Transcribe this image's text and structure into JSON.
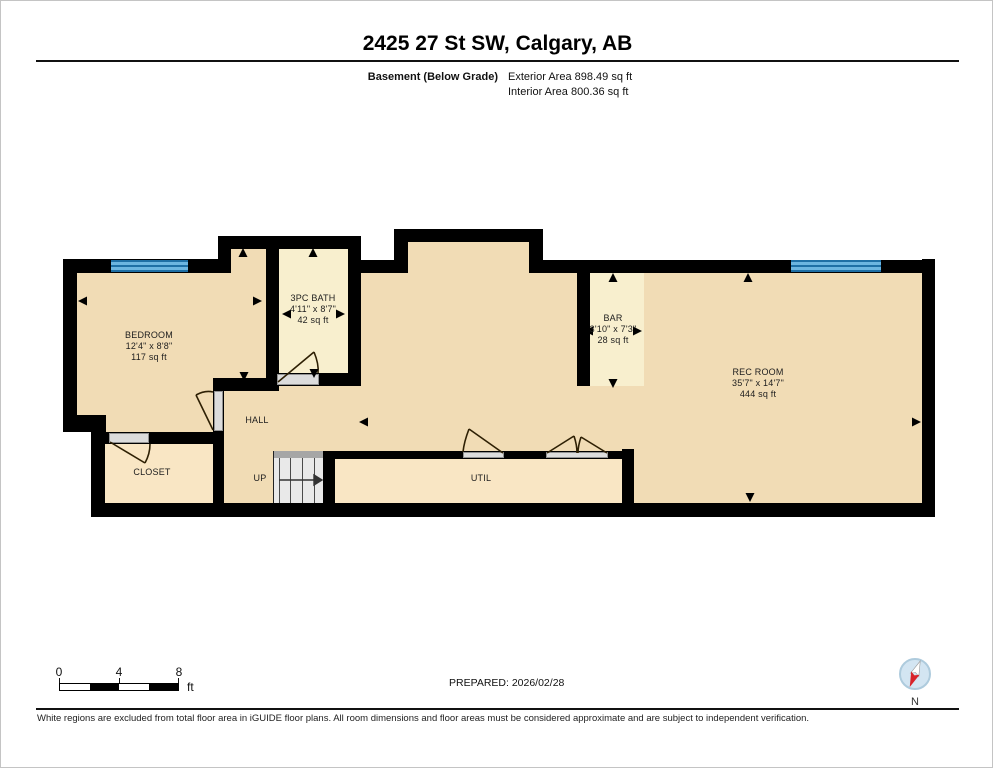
{
  "header": {
    "title": "2425 27 St SW, Calgary, AB",
    "floor_label": "Basement (Below Grade)",
    "exterior_area": "Exterior Area 898.49 sq ft",
    "interior_area": "Interior Area 800.36 sq ft"
  },
  "rooms": [
    {
      "name": "BEDROOM",
      "dims": "12'4\" x 8'8\"",
      "area": "117 sq ft"
    },
    {
      "name": "3PC BATH",
      "dims": "4'11\" x 8'7\"",
      "area": "42 sq ft"
    },
    {
      "name": "BAR",
      "dims": "3'10\" x 7'3\"",
      "area": "28 sq ft"
    },
    {
      "name": "REC ROOM",
      "dims": "35'7\" x 14'7\"",
      "area": "444 sq ft"
    }
  ],
  "labels": {
    "hall": "HALL",
    "closet": "CLOSET",
    "util": "UTIL",
    "up": "UP"
  },
  "scale": {
    "t0": "0",
    "t4": "4",
    "t8": "8",
    "unit": "ft"
  },
  "footer": {
    "prepared": "PREPARED: 2026/02/28",
    "disclaimer": "White regions are excluded from total floor area in iGUIDE floor plans. All room dimensions and floor areas must be considered approximate and are subject to independent verification.",
    "compass_label": "N"
  },
  "colors": {
    "floor_main": "#f1dcb5",
    "floor_bath_bar": "#f8efce",
    "floor_util_closet": "#f9e6c4",
    "wall": "#000000",
    "window_blue": "#6cb5e0",
    "window_blue_dark": "#1e6fa5",
    "door_sill": "#dcdcdc",
    "stairs": "#e9e9e9",
    "compass_red": "#d8232a"
  }
}
